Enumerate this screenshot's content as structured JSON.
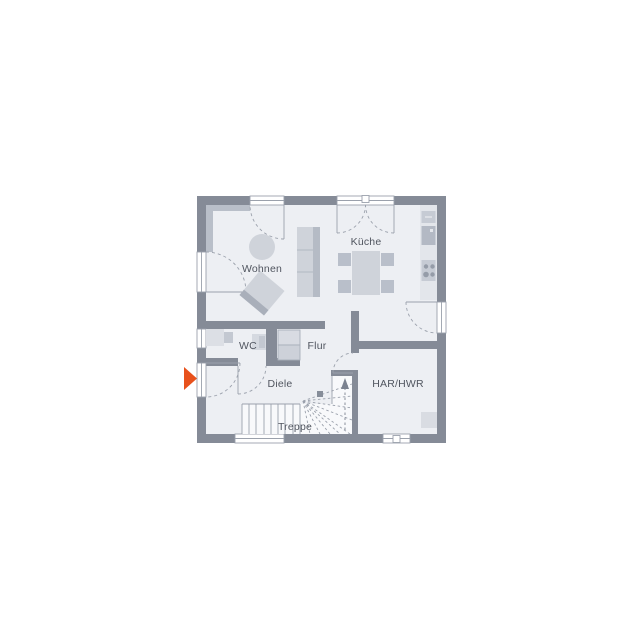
{
  "plan": {
    "type": "floor-plan",
    "rooms": [
      {
        "id": "wohnen",
        "label": "Wohnen"
      },
      {
        "id": "kueche",
        "label": "Küche"
      },
      {
        "id": "wc",
        "label": "WC"
      },
      {
        "id": "flur",
        "label": "Flur"
      },
      {
        "id": "diele",
        "label": "Diele"
      },
      {
        "id": "treppe",
        "label": "Treppe"
      },
      {
        "id": "har-hwr",
        "label": "HAR/HWR"
      }
    ],
    "markers": {
      "entrance_arrow": "right-pointing triangle at entrance door",
      "stair_direction": "up"
    },
    "furniture": [
      "sofa",
      "round-side-table",
      "coffee-table",
      "dining-table",
      "dining-chairs",
      "kitchen-counter",
      "oven",
      "microwave",
      "cooktop",
      "washbasin",
      "toilet",
      "wardrobe",
      "stairs",
      "utility-appliance"
    ],
    "colors": {
      "background": "#FFFFFF",
      "wall": "#858B97",
      "floor": "#EDEFF3",
      "furniture_light": "#CFD3DA",
      "furniture_mid": "#BFC4CD",
      "furniture_dark": "#A9AFBA",
      "line": "#9BA1AC",
      "text": "#50555F",
      "accent": "#E8511C"
    }
  }
}
